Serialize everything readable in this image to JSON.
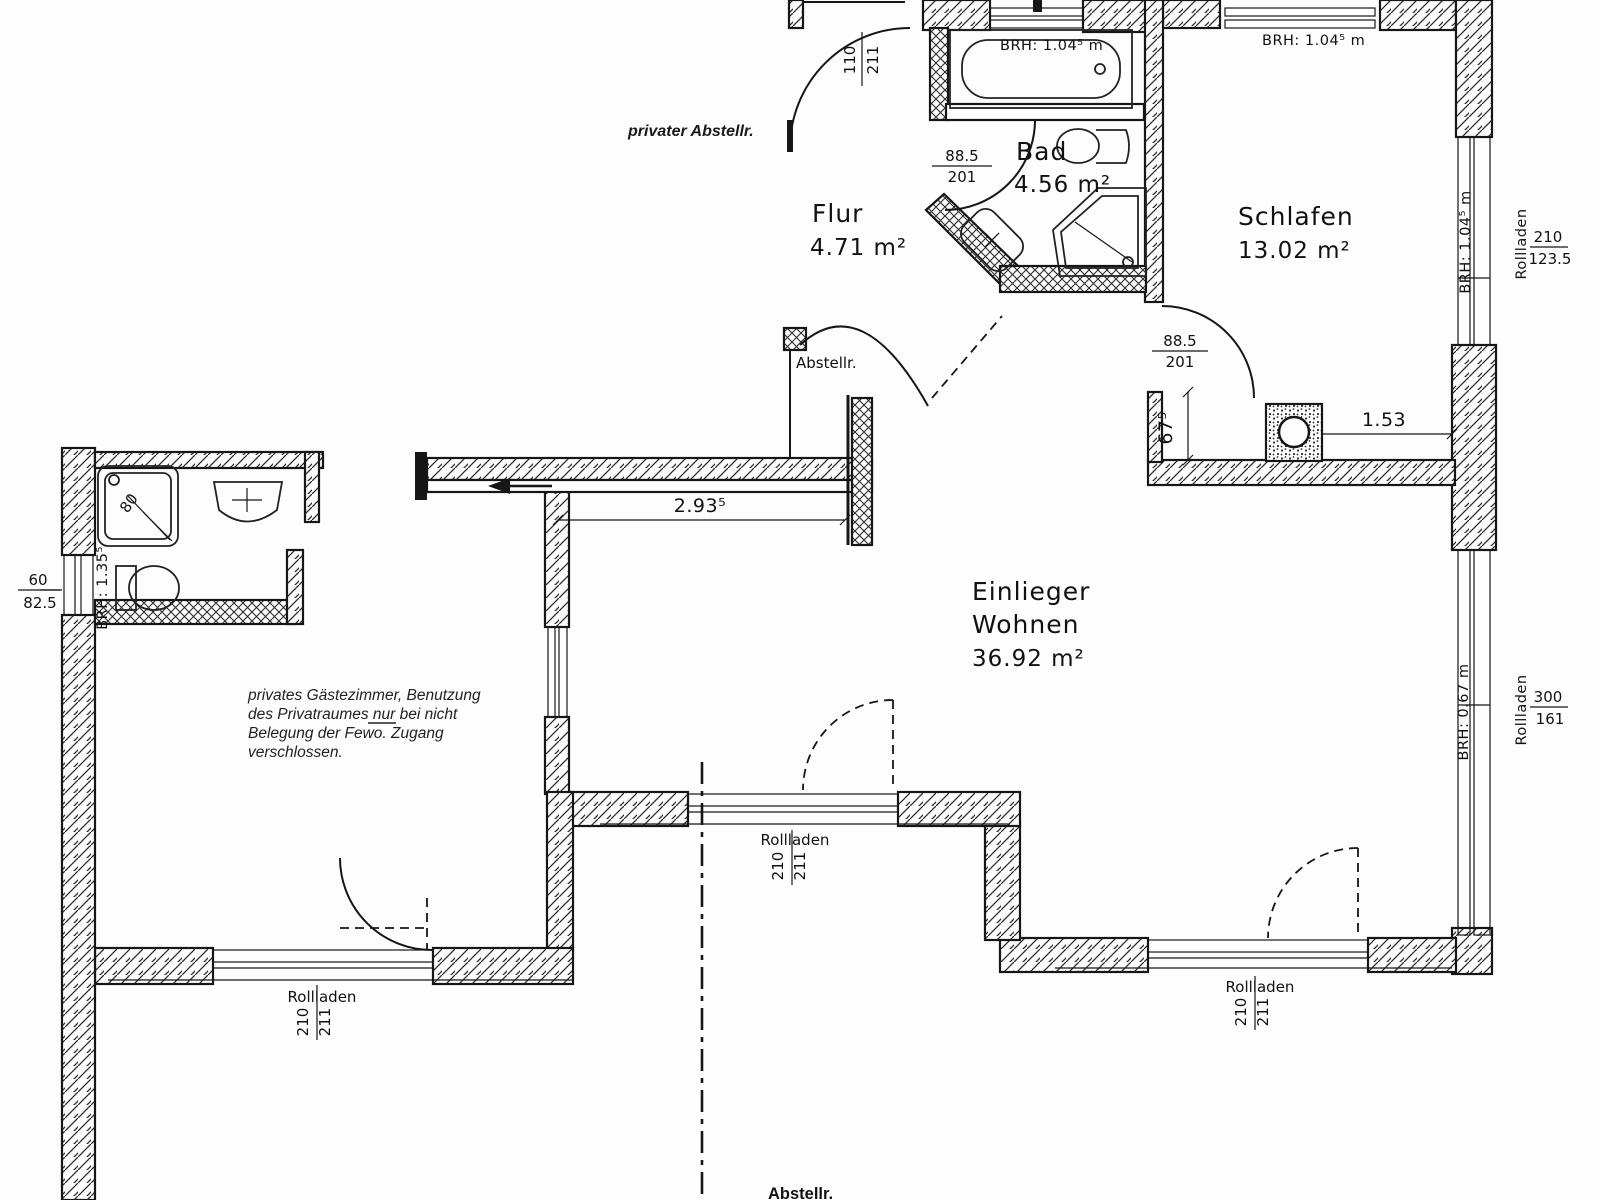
{
  "document": {
    "type": "floor-plan",
    "unit_hint": "m / cm",
    "ink_color": "#161616",
    "paper_color": "#fdfdfd"
  },
  "rooms": {
    "flur": {
      "name": "Flur",
      "area": "4.71 m²"
    },
    "bad": {
      "name": "Bad",
      "area": "4.56 m²"
    },
    "schlafen": {
      "name": "Schlafen",
      "area": "13.02 m²"
    },
    "wohnen": {
      "name1": "Einlieger",
      "name2": "Wohnen",
      "area": "36.92 m²"
    }
  },
  "labels": {
    "private_storage": "privater Abstellr.",
    "storage_flur": "Abstellr.",
    "storage_bottom": "Abstellr.",
    "rollladen": "Rollladen"
  },
  "note": {
    "lines": [
      "privates Gästezimmer, Benutzung",
      "des Privatraumes nur bei nicht",
      "Belegung der Fewo. Zugang",
      "verschlossen."
    ]
  },
  "dimensions": {
    "interior_width": "2.93⁵",
    "chimney_offset": "1.53",
    "wall_recess": "67⁵",
    "shower_size": "80"
  },
  "doors": {
    "flur_top": {
      "w": "110",
      "h": "211"
    },
    "bad": {
      "w": "88.5",
      "h": "201"
    },
    "schlafen": {
      "w": "88.5",
      "h": "201"
    }
  },
  "windows": {
    "bath_top_brh": "BRH: 1.04⁵ m",
    "schlafen_top_brh": "BRH: 1.04⁵ m",
    "schlafen_right_brh": "BRH: 1.04⁵ m",
    "schlafen_right": {
      "w": "210",
      "h": "123.5"
    },
    "wohnen_right_brh": "BRH: 0.67 m",
    "wohnen_right": {
      "w": "300",
      "h": "161"
    },
    "guest_left": {
      "w": "60",
      "h": "82.5"
    },
    "guest_left_brh": "BRH: 1.35⁵",
    "shutter_door": {
      "w": "210",
      "h": "211"
    }
  }
}
